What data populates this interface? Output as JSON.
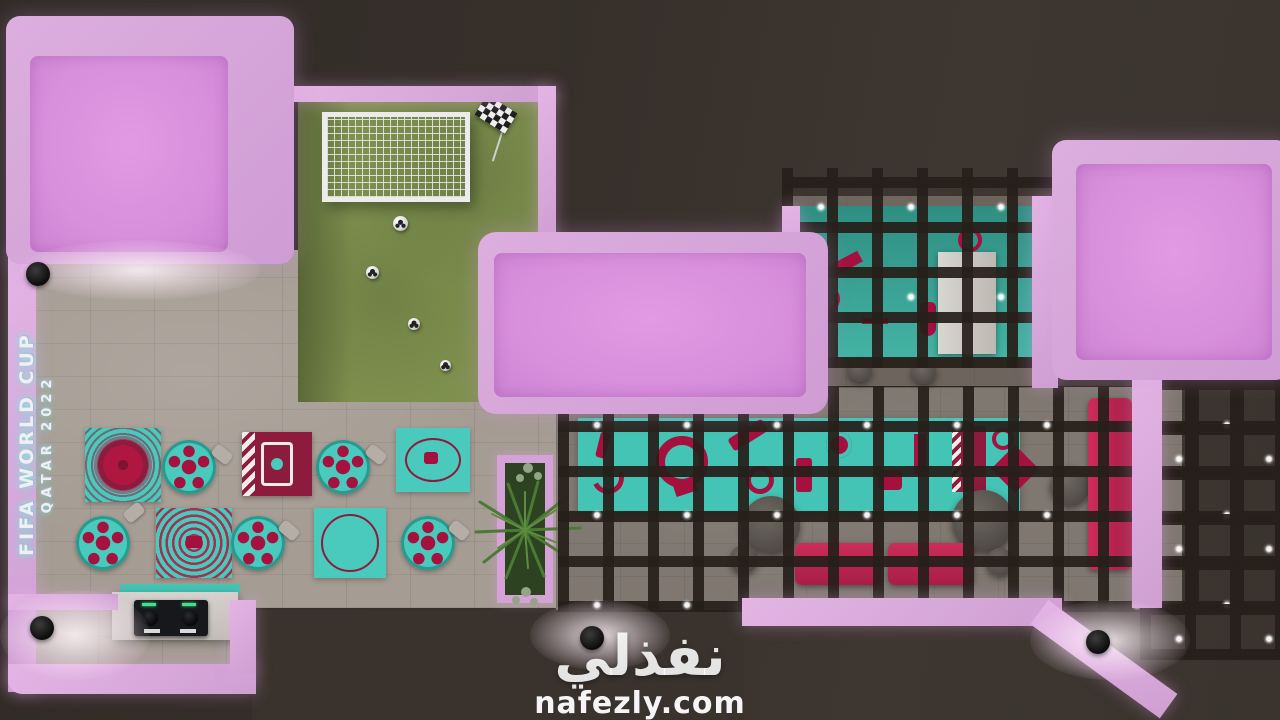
{
  "meta": {
    "description": "Top-down 3D architectural render of a FIFA World Cup Qatar 2022 themed cafe and games lounge",
    "view": "bird's-eye interior floor plan render"
  },
  "watermark": {
    "arabic": "نفذلي",
    "site": "nafezly.com"
  },
  "wall_sign": {
    "line1": "FIFA WORLD CUP",
    "line2": "QATAR 2022"
  },
  "palette": {
    "bg_dark": "#37302b",
    "pink_wall": "#d8a8da",
    "pink_panel": "#d98fdd",
    "teal": "#43c4b4",
    "qatar_maroon": "#8d1b3d",
    "crimson": "#b01740",
    "sofa_red": "#c22a52",
    "grass_green": "#7e904e",
    "stone_floor": "#a59c93",
    "pergola_dark": "#2a241f",
    "white": "#f0ecec"
  },
  "rooms": [
    {
      "name": "soccer-play-area",
      "items": [
        "soccer-goal-with-net",
        "four-soccer-balls",
        "checkered-corner-flag",
        "artificial-grass"
      ]
    },
    {
      "name": "dining-area",
      "items": [
        "five-round-football-pattern-tables",
        "qatar-flag-rug",
        "four-teal-pattern-rugs",
        "chairs"
      ]
    },
    {
      "name": "bar-room",
      "items": [
        "teal-counter",
        "white-fridge",
        "bar-stools"
      ]
    },
    {
      "name": "pergola-lounge",
      "items": [
        "teal-world-cup-mural",
        "red-sofas",
        "round-coffee-tables",
        "string-lights-on-grid"
      ]
    },
    {
      "name": "dj-corner",
      "items": [
        "white-counter",
        "dj-mixer-deck"
      ]
    },
    {
      "name": "planter",
      "items": [
        "palm-plants"
      ]
    }
  ],
  "counts": {
    "soccer_balls": 4,
    "round_tables": 5,
    "themed_rugs": 5,
    "sofas": 3,
    "roof_skylight_boxes": 3,
    "spotlights": 4
  }
}
